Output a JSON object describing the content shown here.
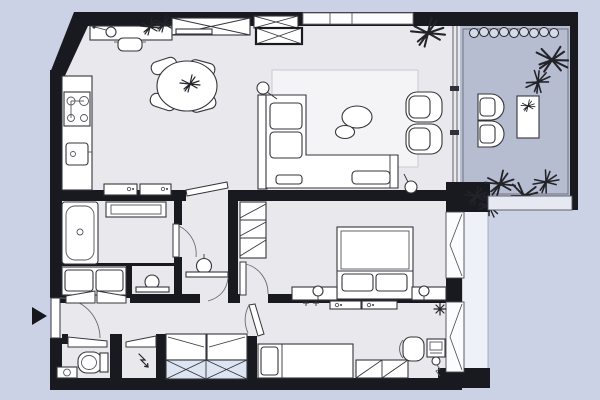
{
  "document": {
    "type": "apartment-floor-plan-top-view",
    "text_labels_visible": "none",
    "entrance_marker": "black-right-pointing-triangle-left-wall"
  },
  "palette": {
    "background": "#ccd2e6",
    "interior_floor": "#e9e9ed",
    "rug": "#f4f4f7",
    "walls": "#191920",
    "balcony_floor": "#b6bdd0",
    "wardrobe_crossed_fill": "#dde4f2",
    "window_sill_band": "#eef1f8",
    "furniture_fill": "#ffffff",
    "furniture_outline": "#35353c"
  },
  "rooms": [
    {
      "name": "kitchen-dining-area",
      "position": "top-left",
      "furniture": [
        "kitchen-counter",
        "cooktop-4-burners",
        "kitchen-sink",
        "wall-desk",
        "swing-arm-desk-lamp",
        "stool",
        "dining-table-round",
        "dining-chairs x4",
        "potted-plant-on-table",
        "desk-plants x2",
        "low-cabinets x2"
      ]
    },
    {
      "name": "living-room",
      "position": "top-center",
      "furniture": [
        "corner-sofa-L-shape",
        "seat-cushions x3",
        "armchairs x2",
        "coffee-table-oval x2",
        "area-rug",
        "floor-lamp x2",
        "built-in-wardrobes x3",
        "high-window-top-wall",
        "corner-plant",
        "glass-wall-to-balcony"
      ]
    },
    {
      "name": "bathroom",
      "position": "middle-left",
      "furniture": [
        "bathtub",
        "washer-dryer-cabinet",
        "double-sink-vanity",
        "washbasin-with-bar",
        "door-swing"
      ]
    },
    {
      "name": "powder-room",
      "position": "middle-center-left",
      "furniture": [
        "pedestal-washbasin",
        "shelf-bar",
        "door-to-living-room"
      ]
    },
    {
      "name": "bedroom",
      "position": "middle-right",
      "furniture": [
        "double-bed",
        "pillows x2",
        "nightstands x2",
        "bedside-lamps x2",
        "shelved-wardrobe",
        "casement-window",
        "door-swing"
      ]
    },
    {
      "name": "kids-room-office",
      "position": "bottom-right",
      "furniture": [
        "single-bed-with-pillow",
        "low-dresser-2-cells",
        "desk",
        "desk-chair",
        "desk-floor-lamp",
        "ceiling-light-burst",
        "wall-cabinets x2",
        "coat-hooks x2",
        "casement-window",
        "door-swing"
      ]
    },
    {
      "name": "hallway",
      "position": "bottom-left",
      "furniture": [
        "entrance-door-with-swing",
        "open-wardrobes x2",
        "crossed-wardrobe-2-cells",
        "double-closet-doors"
      ]
    },
    {
      "name": "wc",
      "position": "bottom-left-corner",
      "furniture": [
        "toilet-with-cistern",
        "hand-basin",
        "door-swing"
      ]
    },
    {
      "name": "utility-closet",
      "position": "bottom-left",
      "furniture": [
        "electric-panel-lightning-symbol",
        "door-swing"
      ]
    },
    {
      "name": "balcony",
      "position": "right",
      "furniture": [
        "outdoor-chairs x2",
        "outdoor-table",
        "table-plant",
        "planter-box-row x9",
        "large-plants x6",
        "glazing-lines",
        "railing-band"
      ]
    }
  ],
  "icons": [
    "entrance-arrow-icon",
    "plant-icon",
    "burst-light-icon",
    "lightning-icon",
    "cooktop-burner-icon",
    "sink-drain-icon",
    "door-swing-arc-icon",
    "window-casement-icon"
  ]
}
